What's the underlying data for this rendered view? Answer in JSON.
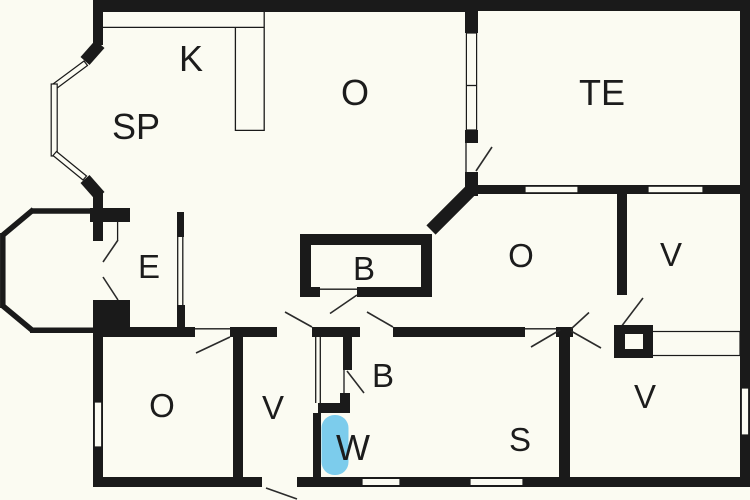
{
  "colors": {
    "wall": "#1a1a1a",
    "floor": "#fbfbf2",
    "label": "#1c1c1c",
    "fixture_blue": "#7cccec"
  },
  "rooms": [
    {
      "id": "k",
      "label": "K"
    },
    {
      "id": "sp",
      "label": "SP"
    },
    {
      "id": "o-top",
      "label": "O"
    },
    {
      "id": "te",
      "label": "TE"
    },
    {
      "id": "e",
      "label": "E"
    },
    {
      "id": "b-upper",
      "label": "B"
    },
    {
      "id": "o-mid",
      "label": "O"
    },
    {
      "id": "v-top-right",
      "label": "V"
    },
    {
      "id": "o-bottom-left",
      "label": "O"
    },
    {
      "id": "v-vestibule",
      "label": "V"
    },
    {
      "id": "b-lower",
      "label": "B"
    },
    {
      "id": "w-wc",
      "label": "W"
    },
    {
      "id": "s",
      "label": "S"
    },
    {
      "id": "v-bottom-right",
      "label": "V"
    }
  ]
}
